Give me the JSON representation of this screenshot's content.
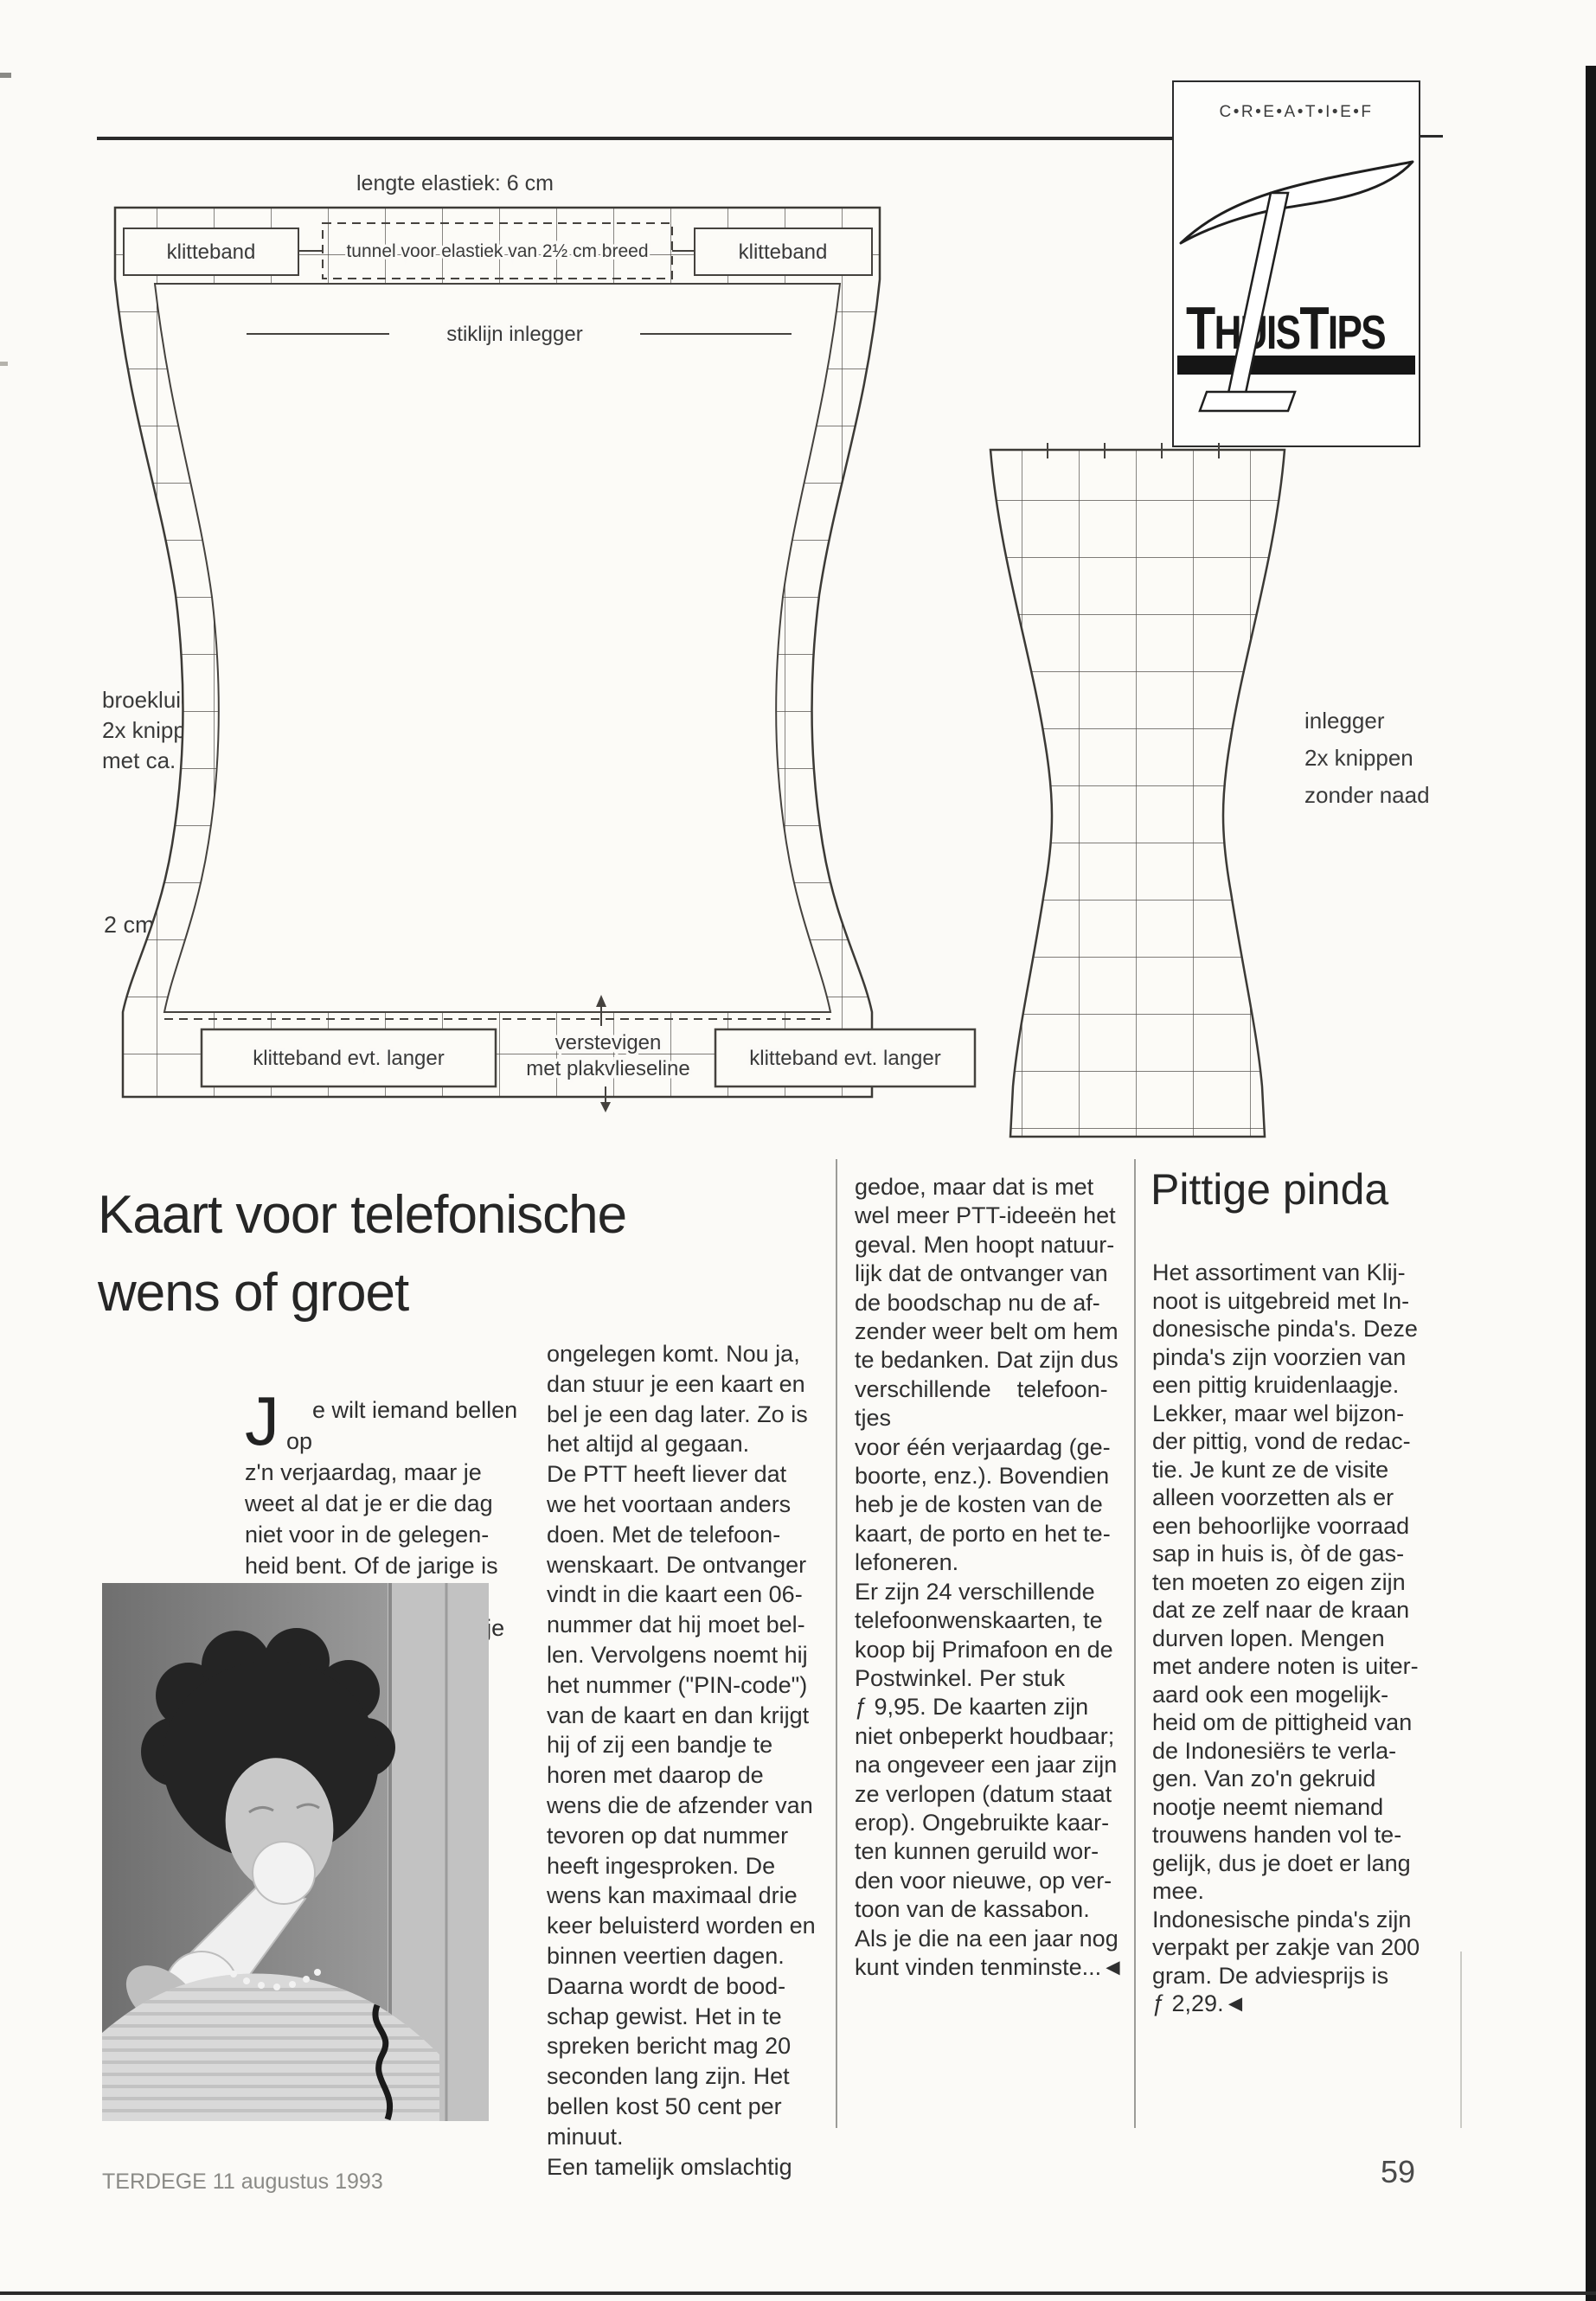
{
  "page": {
    "footer_left": "TERDEGE 11 augustus 1993",
    "page_number": "59"
  },
  "logo": {
    "creatief": "C•R•E•A•T•I•E•F",
    "t1": "T",
    "huis": "HUIS",
    "t2": "T",
    "ips": "IPS"
  },
  "pattern": {
    "lengte_elastiek": "lengte elastiek: 6 cm",
    "klitteband_top_left": "klitteband",
    "tunnel_breed": "tunnel voor elastiek van 2½ cm breed",
    "klitteband_top_right": "klitteband",
    "stiklijn_inlegger": "stiklijn inlegger",
    "tunnel_smal_left": "tunnel voor smal elastiek; lengte ca. 20 cm",
    "tunnel_smal_right": "tunnel voor smal elastiek; lengte ca. 20 cm",
    "broekluier_note": "broekluier\n2x knippen\nmet ca. 1 cm naad",
    "schaal": "2 cm",
    "klitteband_bottom_left": "klitteband evt. langer",
    "verstevigen": "verstevigen",
    "plakvlieseline": "met plakvlieseline",
    "klitteband_bottom_right": "klitteband evt. langer",
    "inlegger_note": "inlegger\n2x knippen\nzonder naad"
  },
  "article_kaart": {
    "title": "Kaart voor telefonische\nwens of groet",
    "dropcap": "J",
    "col1": "e wilt iemand bellen op\nz'n verjaardag, maar je\nweet al dat je er die dag\nniet voor in de gelegen-\nheid bent. Of de jarige is\ndie dag niet bereikbaar.\nOf stel dat het telefoontje",
    "col2": "ongelegen komt. Nou ja,\ndan stuur je een kaart en\nbel je een dag later. Zo is\nhet altijd al gegaan.\nDe PTT heeft liever dat\nwe het voortaan anders\ndoen. Met de telefoon-\nwenskaart. De ontvanger\nvindt in die kaart een 06-\nnummer dat hij moet bel-\nlen. Vervolgens noemt hij\nhet nummer (\"PIN-code\")\nvan de kaart en dan krijgt\nhij of zij een bandje te\nhoren met daarop de\nwens die de afzender van\ntevoren op dat nummer\nheeft ingesproken. De\nwens kan maximaal drie\nkeer beluisterd worden en\nbinnen veertien dagen.\nDaarna wordt de bood-\nschap gewist. Het in te\nspreken bericht mag 20\nseconden lang zijn. Het\nbellen kost 50 cent per\nminuut.\nEen tamelijk omslachtig",
    "col3": "gedoe, maar dat is met\nwel meer PTT-ideeën het\ngeval. Men hoopt natuur-\nlijk dat de ontvanger van\nde boodschap nu de af-\nzender weer belt om hem\nte bedanken. Dat zijn dus\nverschillende    telefoon-\ntjes\nvoor één verjaardag (ge-\nboorte, enz.). Bovendien\nheb je de kosten van de\nkaart, de porto en het te-\nlefoneren.\nEr zijn 24 verschillende\ntelefoonwenskaarten, te\nkoop bij Primafoon en de\nPostwinkel. Per stuk\nƒ 9,95. De kaarten zijn\nniet onbeperkt houdbaar;\nna ongeveer een jaar zijn\nze verlopen (datum staat\nerop). Ongebruikte kaar-\nten kunnen geruild wor-\nden voor nieuwe, op ver-\ntoon van de kassabon.\nAls je die na een jaar nog\nkunt vinden tenminste...◄"
  },
  "article_pinda": {
    "title": "Pittige pinda",
    "body": "Het assortiment van Klij-\nnoot is uitgebreid met In-\ndonesische pinda's. Deze\npinda's zijn voorzien van\neen pittig kruidenlaagje.\nLekker, maar wel bijzon-\nder pittig, vond de redac-\ntie. Je kunt ze de visite\nalleen voorzetten als er\neen behoorlijke voorraad\nsap in huis is, òf de gas-\nten moeten zo eigen zijn\ndat ze zelf naar de kraan\ndurven lopen. Mengen\nmet andere noten is uiter-\naard ook een mogelijk-\nheid om de pittigheid van\nde Indonesiërs te verla-\ngen. Van zo'n gekruid\nnootje neemt niemand\ntrouwens handen vol te-\ngelijk, dus je doet er lang\nmee.\nIndonesische pinda's zijn\nverpakt per zakje van 200\ngram. De adviesprijs is\nƒ 2,29.◄"
  }
}
